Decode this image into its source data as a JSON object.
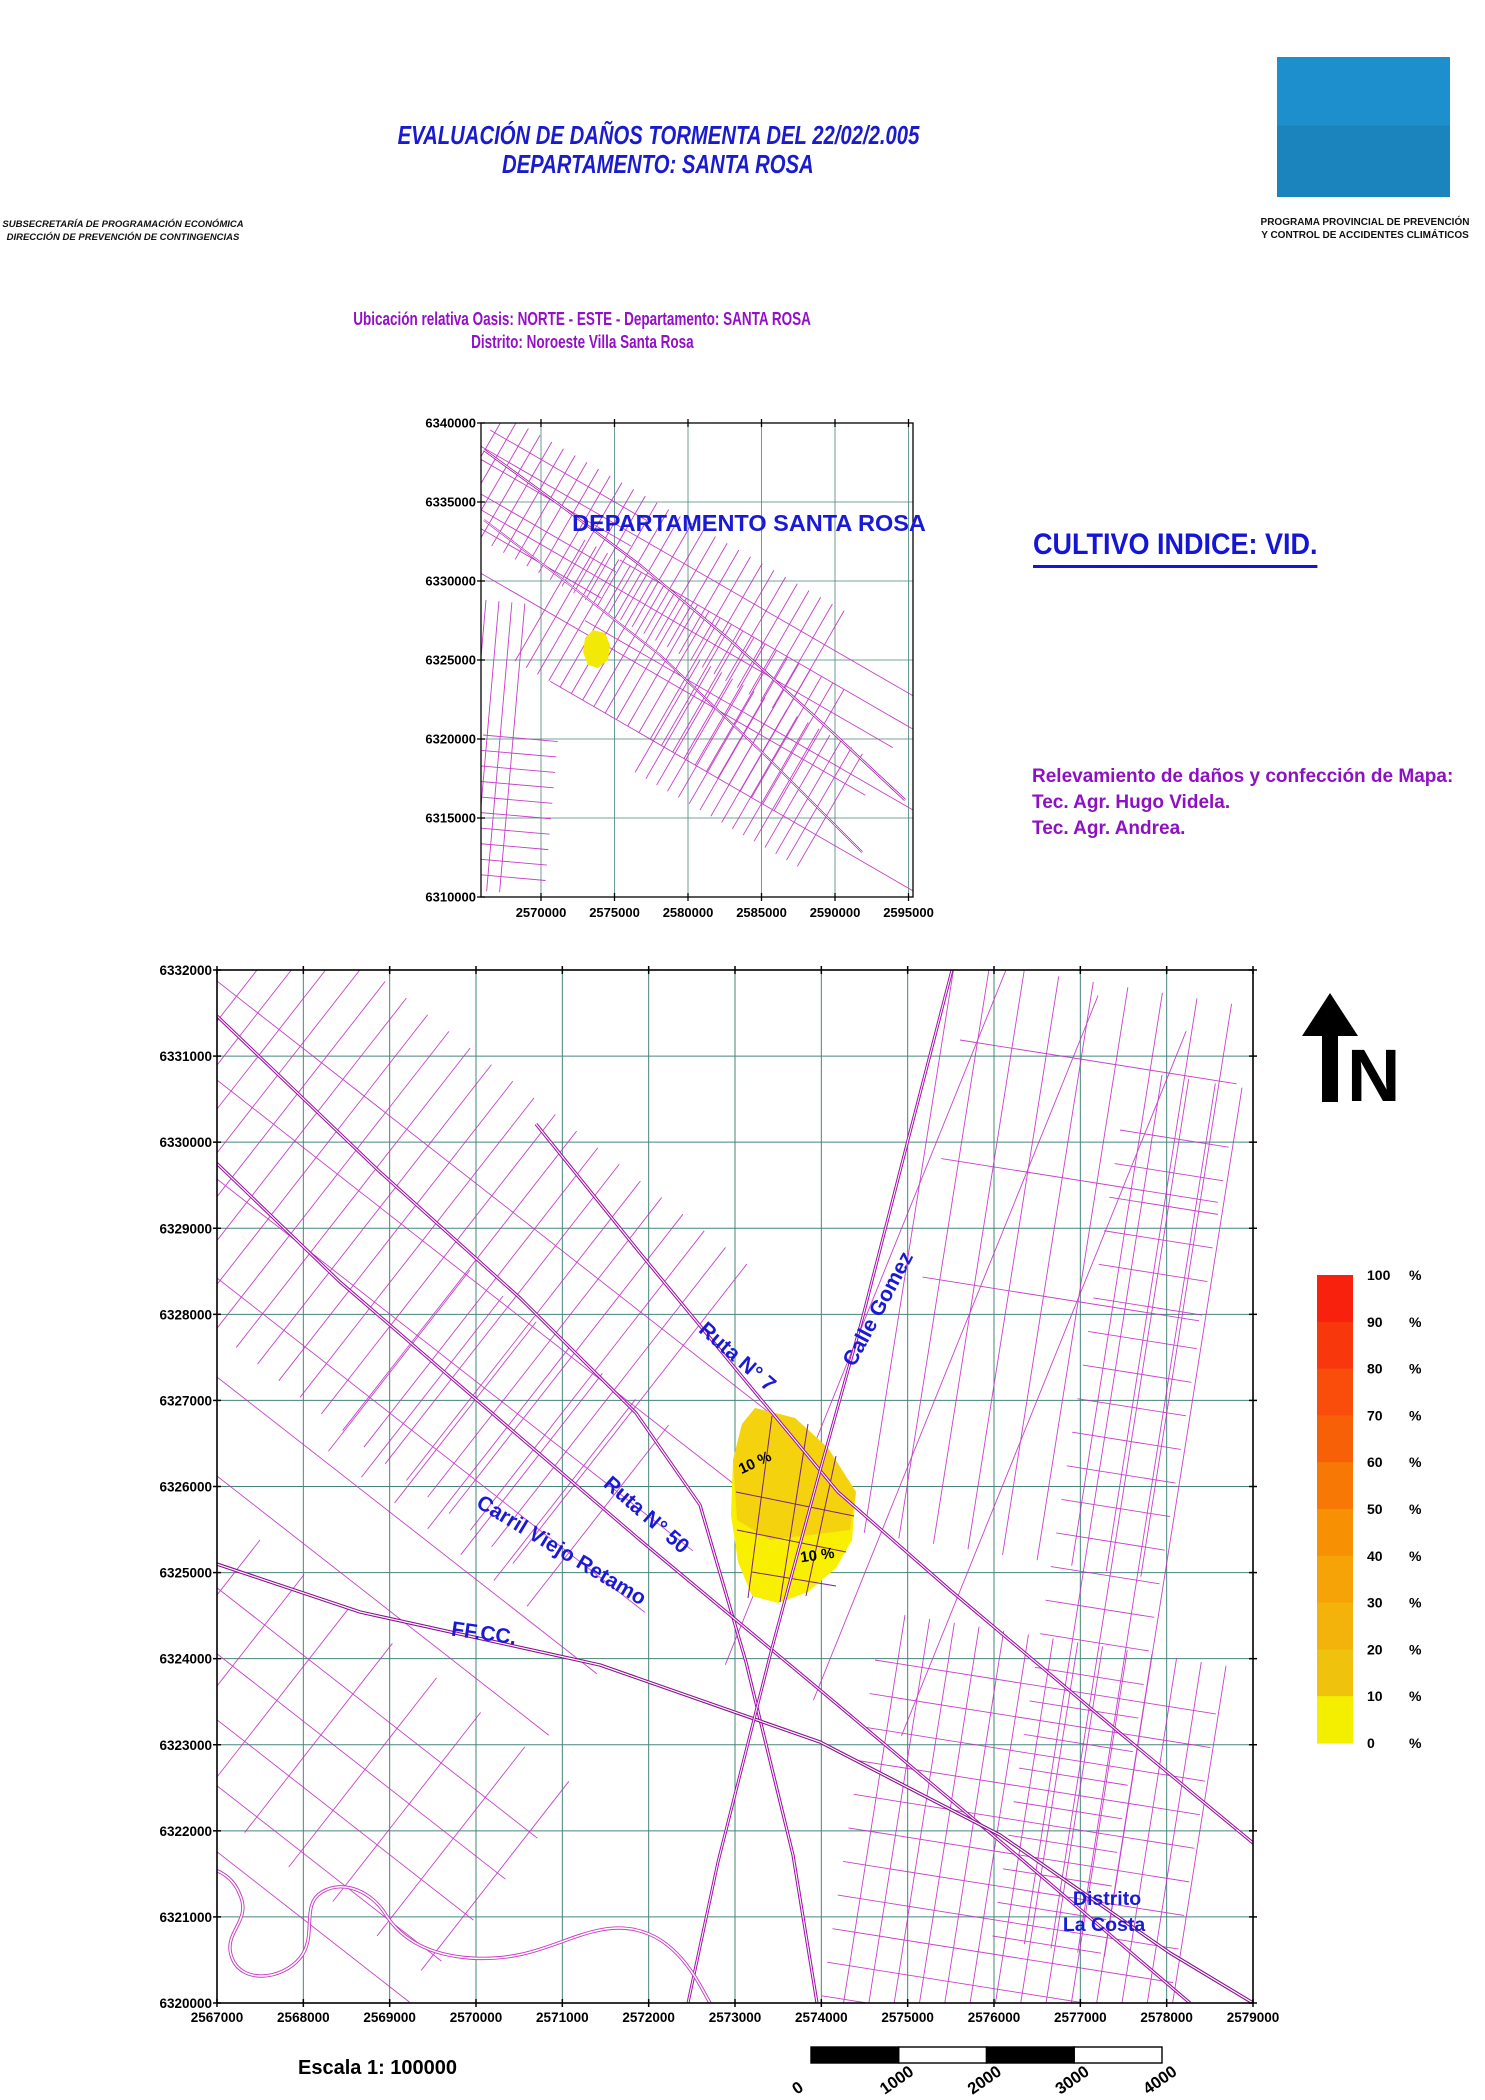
{
  "colors": {
    "title_blue": "#1A1ACF",
    "heading_purple": "#9410C8",
    "map_label_blue": "#1A1AD6",
    "logo_blue": "#1B87C4",
    "parcel_magenta": "#C12EC4",
    "road_purple": "#A012A8",
    "grid_teal": "#46857A",
    "damage_yellow": "#F5E400"
  },
  "header": {
    "title_line1": "EVALUACIÓN DE DAÑOS TORMENTA DEL 22/02/2.005",
    "title_line2": "DEPARTAMENTO: SANTA ROSA",
    "org_left": [
      "SUBSECRETARÍA DE PROGRAMACIÓN ECONÓMICA",
      "DIRECCIÓN DE PREVENCIÓN DE CONTINGENCIAS"
    ],
    "org_right": [
      "PROGRAMA PROVINCIAL DE PREVENCIÓN",
      "Y CONTROL DE ACCIDENTES CLIMÁTICOS"
    ]
  },
  "subtitle": {
    "line1": "Ubicación relativa Oasis: NORTE - ESTE - Departamento: SANTA ROSA",
    "line2": "Distrito: Noroeste Villa Santa Rosa"
  },
  "overview_map": {
    "title": "DEPARTAMENTO  SANTA ROSA",
    "y_ticks": [
      "6340000",
      "6335000",
      "6330000",
      "6325000",
      "6320000",
      "6315000",
      "6310000"
    ],
    "x_ticks": [
      "2570000",
      "2575000",
      "2580000",
      "2585000",
      "2590000",
      "2595000"
    ]
  },
  "cultivo_label": "CULTIVO INDICE:   VID.",
  "credits": [
    "Relevamiento de daños y confección de Mapa:",
    "Tec. Agr. Hugo Videla.",
    "Tec. Agr. Andrea."
  ],
  "main_map": {
    "y_ticks": [
      "6332000",
      "6331000",
      "6330000",
      "6329000",
      "6328000",
      "6327000",
      "6326000",
      "6325000",
      "6324000",
      "6323000",
      "6322000",
      "6321000",
      "6320000"
    ],
    "x_ticks": [
      "2567000",
      "2568000",
      "2569000",
      "2570000",
      "2571000",
      "2572000",
      "2573000",
      "2574000",
      "2575000",
      "2576000",
      "2577000",
      "2578000",
      "2579000"
    ],
    "road_labels": [
      {
        "text": "Ruta N° 7",
        "x": 733,
        "y": 1362,
        "rot": 41
      },
      {
        "text": "Calle Gomez",
        "x": 884,
        "y": 1312,
        "rot": -62
      },
      {
        "text": "Ruta N° 50",
        "x": 642,
        "y": 1520,
        "rot": 41
      },
      {
        "text": "Carril Viejo Retamo",
        "x": 558,
        "y": 1556,
        "rot": 31
      },
      {
        "text": "FF.CC.",
        "x": 483,
        "y": 1640,
        "rot": 8
      }
    ],
    "damage_labels": [
      {
        "text": "10 %",
        "x": 757,
        "y": 1467,
        "rot": -25
      },
      {
        "text": "10 %",
        "x": 818,
        "y": 1560,
        "rot": -8
      }
    ],
    "district_label": [
      "Distrito",
      "La Costa"
    ],
    "north_label": "N"
  },
  "legend": {
    "unit": "%",
    "values": [
      "100",
      "90",
      "80",
      "70",
      "60",
      "50",
      "40",
      "30",
      "20",
      "10",
      "0"
    ],
    "colors": [
      "#F8210D",
      "#F8370D",
      "#F84D0B",
      "#F86008",
      "#F87806",
      "#F89004",
      "#F6A307",
      "#F3B30B",
      "#EFC30D",
      "#F4EF00"
    ]
  },
  "footer": {
    "scale_label": "Escala 1: 100000",
    "bar_labels": [
      "0",
      "1000",
      "2000",
      "3000",
      "4000"
    ]
  }
}
